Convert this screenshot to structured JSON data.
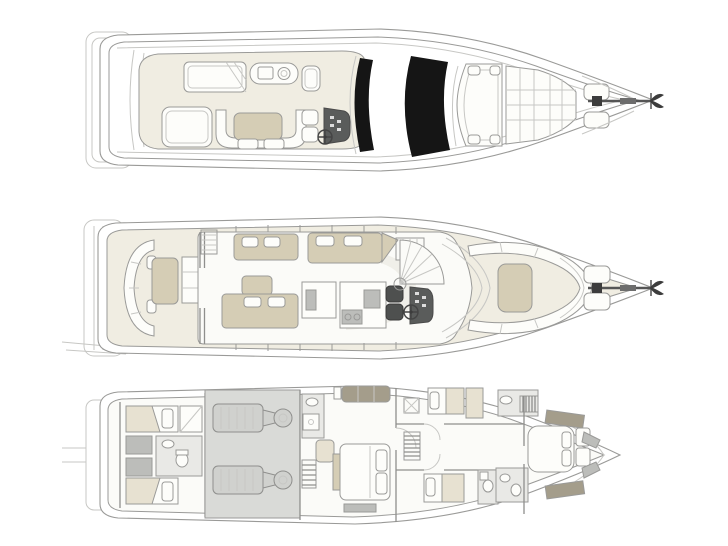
{
  "palette": {
    "background": "#ffffff",
    "outline": "#9a9a98",
    "outline_light": "#c7c7c4",
    "wall": "#8f8f8d",
    "deck_cream": "#f0ede2",
    "floor_white": "#fbfbf8",
    "cushion_white": "#fdfdfa",
    "tan": "#d5cdb5",
    "beige": "#e7e1d1",
    "dark_tan": "#a49d8b",
    "seat_dark": "#4e504f",
    "console_dark": "#5a5c5b",
    "fixture_gray": "#bcbdba",
    "room_gray": "#e9e9e6",
    "engine_room": "#d9dad7",
    "engine_fill": "#d0d1ce",
    "glass_black": "#151515",
    "watermark": "#f0efe9"
  },
  "diagram": {
    "type": "yacht-deck-plans",
    "orientation": "bow-right",
    "decks": [
      {
        "id": "flybridge-deck",
        "aria": "Flybridge deck plan",
        "features": [
          "swim-platform",
          "sun-lounger",
          "wet-bar-with-sink-and-grill",
          "u-shaped-seating",
          "cocktail-table",
          "companion-seat",
          "helm-seats",
          "helm-console",
          "steering-wheel",
          "black-glass-sunroof-panels",
          "bow-sun-pads",
          "deck-hatches",
          "anchor-windlass",
          "anchor"
        ]
      },
      {
        "id": "main-deck",
        "aria": "Main deck plan",
        "features": [
          "swim-platform",
          "aft-cockpit-curved-sofa",
          "cockpit-table",
          "shelf-unit",
          "flybridge-stairs",
          "salon-sofa",
          "coffee-table",
          "dinette-bench",
          "galley-island",
          "galley-counter",
          "helm-seats",
          "helm-console",
          "steering-wheel",
          "spiral-staircase",
          "windshield",
          "bow-lounge-seating",
          "bow-sun-pad",
          "deck-hatches",
          "anchor-windlass",
          "anchor"
        ]
      },
      {
        "id": "lower-deck",
        "aria": "Lower deck plan",
        "features": [
          "crew-cabin-twin-berths",
          "crew-bathroom",
          "engine-room",
          "twin-engines",
          "master-cabin",
          "master-bed",
          "master-sofa",
          "master-bathroom",
          "wardrobe",
          "companionway-stairs",
          "guest-cabin-port",
          "guest-cabin-starboard",
          "guest-bathrooms",
          "vip-cabin",
          "vip-bed",
          "bow-stowage"
        ]
      }
    ]
  }
}
